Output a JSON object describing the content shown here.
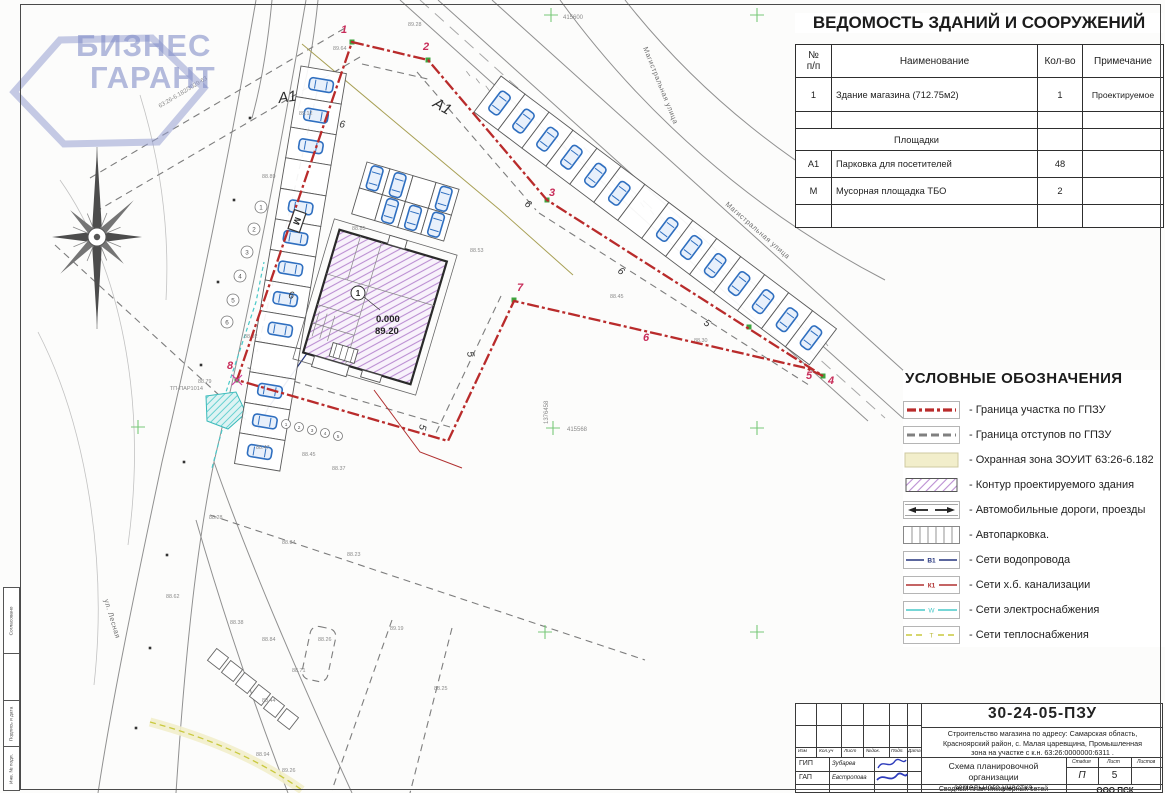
{
  "colors": {
    "boundary": "#b92b2b",
    "setback": "#7d7d7d",
    "zone_yellow": "#f2eecb",
    "hatch_purple": "#bb8fd2",
    "car_blue": "#2f6fc0",
    "water": "#25357e",
    "sewer": "#b03030",
    "electric": "#49c8c8",
    "heat": "#c9c93e",
    "cross_green": "#79c879",
    "vertex_green": "#3da43d",
    "logo": "#8c96c8",
    "frame": "#4a4a4a"
  },
  "logo": {
    "line1": "БИЗНЕС",
    "line2": "ГАРАНТ"
  },
  "buildings_table": {
    "title": "ВЕДОМОСТЬ ЗДАНИЙ И СООРУЖЕНИЙ",
    "columns": {
      "num": "№\nп/п",
      "name": "Наименование",
      "qty": "Кол-во",
      "note": "Примечание"
    },
    "rows": [
      {
        "num": "1",
        "name": "Здание магазина (712.75м2)",
        "qty": "1",
        "note": "Проектируемое"
      }
    ],
    "section_title": "Площадки",
    "section_rows": [
      {
        "num": "А1",
        "name": "Парковка для посетителей",
        "qty": "48",
        "note": ""
      },
      {
        "num": "М",
        "name": "Мусорная площадка ТБО",
        "qty": "2",
        "note": ""
      }
    ]
  },
  "legend": {
    "title": "УСЛОВНЫЕ ОБОЗНАЧЕНИЯ",
    "items": [
      {
        "label": "- Граница участка по ГПЗУ"
      },
      {
        "label": "- Граница отступов по ГПЗУ"
      },
      {
        "label": "- Охранная зона ЗОУИТ 63:26-6.182"
      },
      {
        "label": "- Контур проектируемого здания"
      },
      {
        "label": "- Автомобильные дороги, проезды"
      },
      {
        "label": "- Автопарковка."
      },
      {
        "label": "- Сети водопровода",
        "tag": "В1"
      },
      {
        "label": "- Сети х.б. канализации",
        "tag": "К1"
      },
      {
        "label": "- Сети электроснабжения",
        "tag": "W"
      },
      {
        "label": "- Сети теплоснабжения",
        "tag": "Т"
      }
    ]
  },
  "titleblock": {
    "doc_number": "30-24-05-ПЗУ",
    "address_line1": "Строительство магазина по адресу: Самарская область,",
    "address_line2": "Красноярский район, с. Малая царевщина, Промышленная",
    "address_line3": "зона на участке с к.н. 63:26:0000000:6311 .",
    "sheet_title_line1": "Схема планировочной организации",
    "sheet_title_line2": "земельного участка",
    "cols": {
      "izm": "Изм",
      "kol": "Кол.уч",
      "list": "Лист",
      "doc": "№док.",
      "sign": "Подп.",
      "date": "Дата"
    },
    "stage_label": "Стадия",
    "sheet_label": "Лист",
    "sheets_label": "Листов",
    "stage": "П",
    "sheet_num": "5",
    "sheets_total": "",
    "roles": [
      {
        "role": "ГИП",
        "name": "Зубарев"
      },
      {
        "role": "ГАП",
        "name": "Евстропова"
      }
    ],
    "next_row_title": "Сводный план инженерных сетей",
    "company": "ООО ПСК"
  },
  "side_strip": {
    "cells": [
      "Согласовано",
      "",
      "Подпись и дата",
      "Инв. № подл."
    ]
  },
  "plan": {
    "parking_zone_label": "А1",
    "trash_label": "М",
    "building": {
      "number": "1",
      "level": "0.000",
      "mark": "89.20"
    },
    "street_main": "Магистральная улица",
    "street_left": "ул. Лесная",
    "cad_line_label": "63:26-6.182/3029-63",
    "tp_label": "ТП-ПАР1014",
    "coord_top": "415600",
    "coord_mid": "415568",
    "coord_vert": "1376458",
    "vertices": [
      {
        "n": "1",
        "x": 341,
        "y": 33
      },
      {
        "n": "2",
        "x": 423,
        "y": 50
      },
      {
        "n": "3",
        "x": 549,
        "y": 196
      },
      {
        "n": "4",
        "x": 828,
        "y": 384
      },
      {
        "n": "5",
        "x": 806,
        "y": 379
      },
      {
        "n": "6",
        "x": 643,
        "y": 341
      },
      {
        "n": "7",
        "x": 517,
        "y": 291
      },
      {
        "n": "8",
        "x": 227,
        "y": 369
      }
    ],
    "dims": [
      {
        "x": 467,
        "y": 352,
        "r": 80,
        "t": "5"
      },
      {
        "x": 420,
        "y": 424,
        "r": 100,
        "t": "5"
      },
      {
        "x": 703,
        "y": 324,
        "r": 37,
        "t": "5"
      },
      {
        "x": 339,
        "y": 127,
        "r": 9,
        "t": "6"
      },
      {
        "x": 288,
        "y": 298,
        "r": 9,
        "t": "6"
      },
      {
        "x": 524,
        "y": 205,
        "r": 37,
        "t": "6"
      },
      {
        "x": 617,
        "y": 272,
        "r": 37,
        "t": "6"
      }
    ],
    "spot_elevations": [
      {
        "x": 333,
        "y": 50,
        "v": "89.64"
      },
      {
        "x": 408,
        "y": 26,
        "v": "89.28"
      },
      {
        "x": 299,
        "y": 115,
        "v": "89.12"
      },
      {
        "x": 262,
        "y": 178,
        "v": "88.89"
      },
      {
        "x": 352,
        "y": 230,
        "v": "88.85"
      },
      {
        "x": 470,
        "y": 252,
        "v": "88.53"
      },
      {
        "x": 610,
        "y": 298,
        "v": "88.45"
      },
      {
        "x": 694,
        "y": 342,
        "v": "88.30"
      },
      {
        "x": 244,
        "y": 338,
        "v": "88.92"
      },
      {
        "x": 198,
        "y": 383,
        "v": "88.79"
      },
      {
        "x": 256,
        "y": 449,
        "v": "88.47"
      },
      {
        "x": 302,
        "y": 456,
        "v": "88.45"
      },
      {
        "x": 332,
        "y": 470,
        "v": "88.37"
      },
      {
        "x": 209,
        "y": 519,
        "v": "88.28"
      },
      {
        "x": 282,
        "y": 544,
        "v": "88.34"
      },
      {
        "x": 347,
        "y": 556,
        "v": "88.23"
      },
      {
        "x": 166,
        "y": 598,
        "v": "88.62"
      },
      {
        "x": 230,
        "y": 624,
        "v": "88.38"
      },
      {
        "x": 262,
        "y": 641,
        "v": "88.84"
      },
      {
        "x": 318,
        "y": 641,
        "v": "88.26"
      },
      {
        "x": 292,
        "y": 672,
        "v": "88.71"
      },
      {
        "x": 262,
        "y": 702,
        "v": "88.44"
      },
      {
        "x": 256,
        "y": 756,
        "v": "88.94"
      },
      {
        "x": 282,
        "y": 772,
        "v": "89.26"
      },
      {
        "x": 434,
        "y": 690,
        "v": "88.25"
      },
      {
        "x": 390,
        "y": 630,
        "v": "89.19"
      }
    ],
    "generated": {
      "crosses": [
        [
          551,
          15
        ],
        [
          757,
          15
        ],
        [
          138,
          427
        ],
        [
          553,
          428
        ],
        [
          757,
          428
        ],
        [
          545,
          632
        ],
        [
          757,
          632
        ]
      ],
      "tick_line": {
        "x1": 470,
        "y1": 76,
        "x2": 828,
        "y2": 346,
        "n": 38,
        "len": 6
      },
      "parking": [
        {
          "type": "row",
          "x": 301,
          "y": 66,
          "angle": 99.5,
          "count": 13,
          "pitch": 31,
          "depth": 46,
          "no_car": [
            3,
            9
          ]
        },
        {
          "type": "row",
          "x": 474,
          "y": 112,
          "angle": 37,
          "count": 14,
          "pitch": 30,
          "depth": 45,
          "no_car": [
            6
          ]
        },
        {
          "type": "grid",
          "x": 367,
          "y": 162,
          "angle": 16.5,
          "rows": 2,
          "cols": 4,
          "pitch": 24,
          "depth": 27,
          "no_car": [
            2,
            4
          ]
        }
      ],
      "sheds": {
        "size": 15,
        "rot": 38,
        "cells": [
          [
            218,
            659
          ],
          [
            232,
            671
          ],
          [
            246,
            683
          ],
          [
            260,
            695
          ],
          [
            274,
            707
          ],
          [
            288,
            719
          ]
        ]
      },
      "bubbles": [
        {
          "r": 6,
          "cells": [
            [
              261,
              207
            ],
            [
              254,
              229
            ],
            [
              247,
              252
            ],
            [
              240,
              276
            ],
            [
              233,
              300
            ],
            [
              227,
              322
            ]
          ]
        },
        {
          "r": 4.5,
          "cells": [
            [
              286,
              424
            ],
            [
              299,
              427
            ],
            [
              312,
              430
            ],
            [
              325,
              433
            ],
            [
              338,
              436
            ]
          ]
        }
      ],
      "poles": [
        [
          250,
          118
        ],
        [
          234,
          200
        ],
        [
          218,
          282
        ],
        [
          201,
          365
        ],
        [
          184,
          462
        ],
        [
          167,
          555
        ],
        [
          150,
          648
        ],
        [
          136,
          728
        ]
      ],
      "vertex_markers": [
        [
          352,
          42
        ],
        [
          428,
          60
        ],
        [
          547,
          200
        ],
        [
          823,
          376
        ],
        [
          749,
          327
        ],
        [
          514,
          300
        ],
        [
          299,
          217
        ],
        [
          237,
          380
        ]
      ]
    }
  }
}
